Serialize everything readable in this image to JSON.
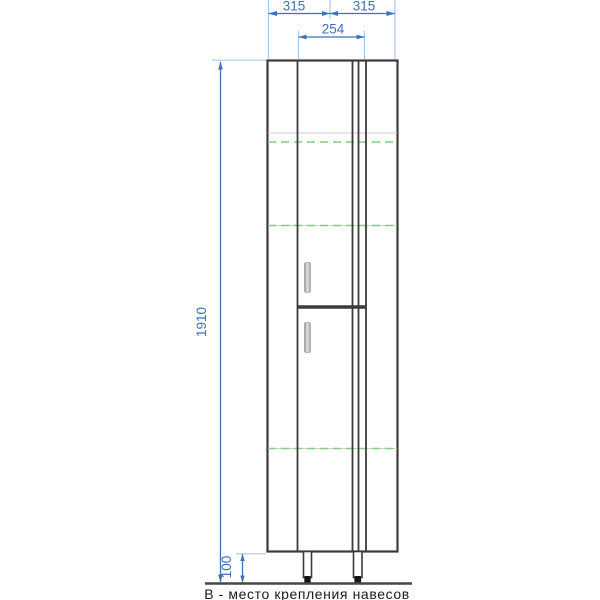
{
  "drawing": {
    "caption": "В - место крепления навесов",
    "dims": {
      "top_left": "315",
      "top_right": "315",
      "door": "254",
      "height": "1910",
      "legs": "100"
    },
    "colors": {
      "dimension": "#3b72c0",
      "extension": "#a9c9ec",
      "outline": "#3b3b3b",
      "hanger_dashed": "#84cc84",
      "shelf": "#cbcbcb",
      "ground": "#474747",
      "caption_text": "#1b1b1b",
      "handle": "#b5b5b5"
    }
  }
}
